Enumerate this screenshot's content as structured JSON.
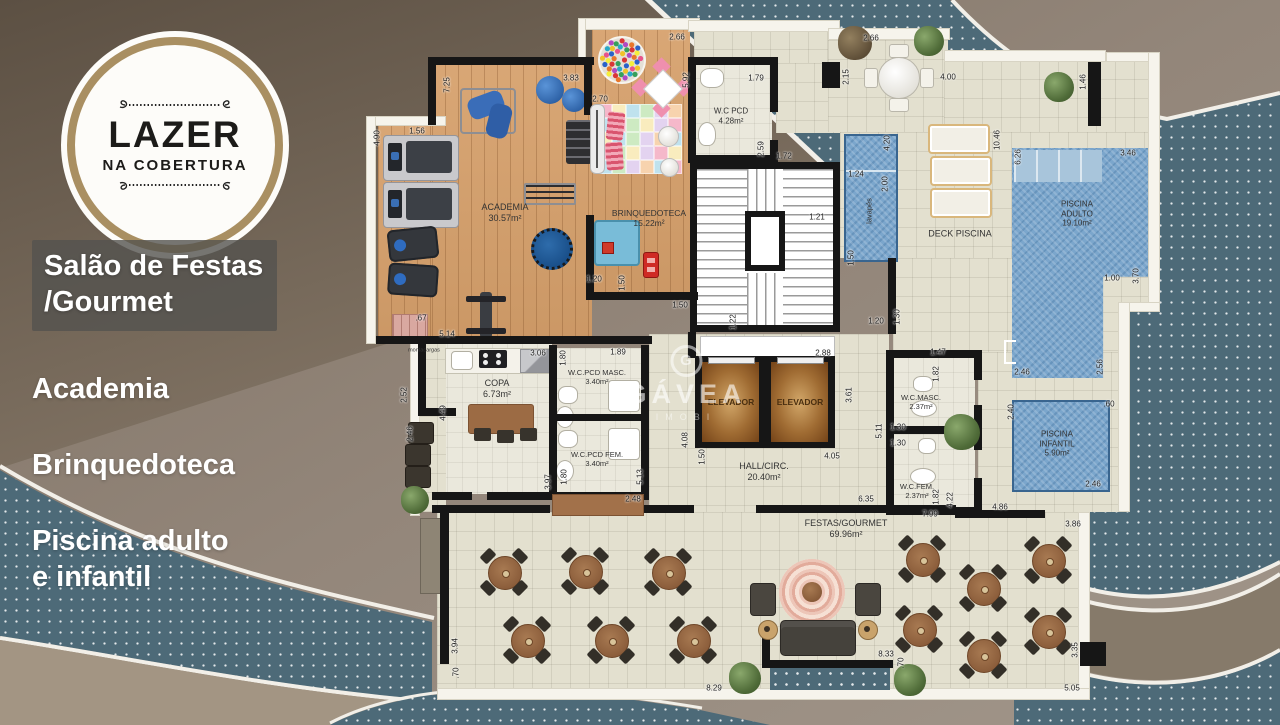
{
  "badge": {
    "title": "LAZER",
    "subtitle": "NA COBERTURA"
  },
  "sidebar": {
    "items": [
      {
        "label": "Salão de Festas\n/Gourmet",
        "highlighted": true
      },
      {
        "label": "Academia",
        "highlighted": false
      },
      {
        "label": "Brinquedoteca",
        "highlighted": false
      },
      {
        "label": "Piscina adulto\ne infantil",
        "highlighted": false
      }
    ]
  },
  "watermark": {
    "initial": "G",
    "name": "GÁVEA",
    "sub": "IMOBI"
  },
  "plan": {
    "rooms": [
      {
        "t": "ACADEMIA\n30.57m²",
        "x": 505,
        "y": 213,
        "s": 9
      },
      {
        "t": "BRINQUEDOTECA\n15.22m²",
        "x": 649,
        "y": 218,
        "s": 8.5
      },
      {
        "t": "W.C PCD\n4.28m²",
        "x": 731,
        "y": 116,
        "s": 8
      },
      {
        "t": "DECK PISCINA",
        "x": 960,
        "y": 234,
        "s": 9
      },
      {
        "t": "lavapés",
        "x": 869,
        "y": 211,
        "s": 7.5,
        "r": -90
      },
      {
        "t": "PISCINA\nADULTO\n19.10m²",
        "x": 1077,
        "y": 214,
        "s": 8
      },
      {
        "t": "PISCINA\nINFANTIL\n5.90m²",
        "x": 1057,
        "y": 444,
        "s": 8
      },
      {
        "t": "COPA\n6.73m²",
        "x": 497,
        "y": 389,
        "s": 9
      },
      {
        "t": "W.C.PCD MASC.\n3.40m²",
        "x": 597,
        "y": 377,
        "s": 7.5
      },
      {
        "t": "W.C.PCD FEM.\n3.40m²",
        "x": 597,
        "y": 459,
        "s": 7.5
      },
      {
        "t": "ELEVADOR",
        "x": 731,
        "y": 402,
        "s": 8.5,
        "b": 1,
        "c": "#4a2f10"
      },
      {
        "t": "ELEVADOR",
        "x": 800,
        "y": 402,
        "s": 8.5,
        "b": 1,
        "c": "#4a2f10"
      },
      {
        "t": "HALL/CIRC.\n20.40m²",
        "x": 764,
        "y": 472,
        "s": 9
      },
      {
        "t": "W.C.MASC.\n2.37m²",
        "x": 921,
        "y": 402,
        "s": 7.5
      },
      {
        "t": "W.C.FEM.\n2.37m²",
        "x": 917,
        "y": 491,
        "s": 7.5
      },
      {
        "t": "FESTAS/GOURMET\n69.96m²",
        "x": 846,
        "y": 529,
        "s": 9
      },
      {
        "t": "montacargas",
        "x": 424,
        "y": 351,
        "s": 5.5
      }
    ],
    "dims": [
      {
        "t": "7.25",
        "x": 447,
        "y": 85,
        "r": -90
      },
      {
        "t": "3.83",
        "x": 571,
        "y": 78
      },
      {
        "t": "2.70",
        "x": 600,
        "y": 99
      },
      {
        "t": "2.66",
        "x": 677,
        "y": 37
      },
      {
        "t": "5.92",
        "x": 686,
        "y": 80,
        "r": -90
      },
      {
        "t": "4.90",
        "x": 377,
        "y": 138,
        "r": -90
      },
      {
        "t": "1.56",
        "x": 417,
        "y": 131
      },
      {
        "t": "1.79",
        "x": 756,
        "y": 78
      },
      {
        "t": "2.59",
        "x": 761,
        "y": 149,
        "r": -90
      },
      {
        "t": "1.72",
        "x": 784,
        "y": 156
      },
      {
        "t": "2.15",
        "x": 846,
        "y": 77,
        "r": -90
      },
      {
        "t": "2.66",
        "x": 871,
        "y": 38
      },
      {
        "t": "4.00",
        "x": 948,
        "y": 77
      },
      {
        "t": "1.46",
        "x": 1083,
        "y": 82,
        "r": -90
      },
      {
        "t": "10.46",
        "x": 997,
        "y": 140,
        "r": -90
      },
      {
        "t": "6.26",
        "x": 1018,
        "y": 157,
        "r": -90
      },
      {
        "t": "3.46",
        "x": 1128,
        "y": 153
      },
      {
        "t": "1.24",
        "x": 856,
        "y": 174
      },
      {
        "t": "4.20",
        "x": 887,
        "y": 143,
        "r": -90
      },
      {
        "t": "2.00",
        "x": 885,
        "y": 184,
        "r": -90
      },
      {
        "t": "1.50",
        "x": 851,
        "y": 258,
        "r": -90
      },
      {
        "t": "1.21",
        "x": 817,
        "y": 217
      },
      {
        "t": "1.22",
        "x": 733,
        "y": 322,
        "r": -90
      },
      {
        "t": "1.20",
        "x": 876,
        "y": 321
      },
      {
        "t": "1.30",
        "x": 897,
        "y": 317,
        "r": -90
      },
      {
        "t": "1.20",
        "x": 594,
        "y": 279
      },
      {
        "t": "1.50",
        "x": 622,
        "y": 283,
        "r": -90
      },
      {
        "t": "1.50",
        "x": 680,
        "y": 305
      },
      {
        "t": ".67",
        "x": 421,
        "y": 318
      },
      {
        "t": "5.14",
        "x": 447,
        "y": 334
      },
      {
        "t": "3.06",
        "x": 538,
        "y": 353
      },
      {
        "t": "1.80",
        "x": 563,
        "y": 358,
        "r": -90
      },
      {
        "t": "1.89",
        "x": 618,
        "y": 352
      },
      {
        "t": "2.88",
        "x": 823,
        "y": 353
      },
      {
        "t": "1.47",
        "x": 938,
        "y": 352
      },
      {
        "t": "1.82",
        "x": 936,
        "y": 374,
        "r": -90
      },
      {
        "t": "3.61",
        "x": 849,
        "y": 395,
        "r": -90
      },
      {
        "t": "4.08",
        "x": 685,
        "y": 440,
        "r": -90
      },
      {
        "t": "1.50",
        "x": 702,
        "y": 457,
        "r": -90
      },
      {
        "t": "4.05",
        "x": 832,
        "y": 456
      },
      {
        "t": "1.30",
        "x": 898,
        "y": 427
      },
      {
        "t": "1.30",
        "x": 898,
        "y": 443
      },
      {
        "t": "5.11",
        "x": 879,
        "y": 431,
        "r": -90
      },
      {
        "t": "2.52",
        "x": 404,
        "y": 395,
        "r": -90
      },
      {
        "t": "4.49",
        "x": 443,
        "y": 413,
        "r": -90
      },
      {
        "t": "2.46",
        "x": 410,
        "y": 434,
        "r": -90
      },
      {
        "t": "3.97",
        "x": 548,
        "y": 482,
        "r": -90
      },
      {
        "t": "1.80",
        "x": 564,
        "y": 477,
        "r": -90
      },
      {
        "t": "5.13",
        "x": 640,
        "y": 477,
        "r": -90
      },
      {
        "t": "2.48",
        "x": 633,
        "y": 499
      },
      {
        "t": "6.35",
        "x": 866,
        "y": 499
      },
      {
        "t": "7.99",
        "x": 930,
        "y": 514
      },
      {
        "t": "4.22",
        "x": 950,
        "y": 500,
        "r": -90
      },
      {
        "t": "1.82",
        "x": 936,
        "y": 497,
        "r": -90
      },
      {
        "t": "4.86",
        "x": 1000,
        "y": 507
      },
      {
        "t": "3.86",
        "x": 1073,
        "y": 524
      },
      {
        "t": "2.46",
        "x": 1022,
        "y": 372
      },
      {
        "t": "2.56",
        "x": 1100,
        "y": 367,
        "r": -90
      },
      {
        "t": "2.40",
        "x": 1011,
        "y": 412,
        "r": -90
      },
      {
        "t": ".60",
        "x": 1109,
        "y": 404
      },
      {
        "t": "2.46",
        "x": 1093,
        "y": 484
      },
      {
        "t": "1.00",
        "x": 1112,
        "y": 278
      },
      {
        "t": "3.70",
        "x": 1136,
        "y": 276,
        "r": -90
      },
      {
        "t": "8.33",
        "x": 886,
        "y": 654
      },
      {
        "t": ".70",
        "x": 901,
        "y": 663,
        "r": -90
      },
      {
        "t": "3.35",
        "x": 1075,
        "y": 650,
        "r": -90
      },
      {
        "t": "5.05",
        "x": 1072,
        "y": 688
      },
      {
        "t": "8.29",
        "x": 714,
        "y": 688
      },
      {
        "t": "3.94",
        "x": 455,
        "y": 646,
        "r": -90
      },
      {
        "t": ".70",
        "x": 456,
        "y": 673,
        "r": -90
      }
    ]
  }
}
